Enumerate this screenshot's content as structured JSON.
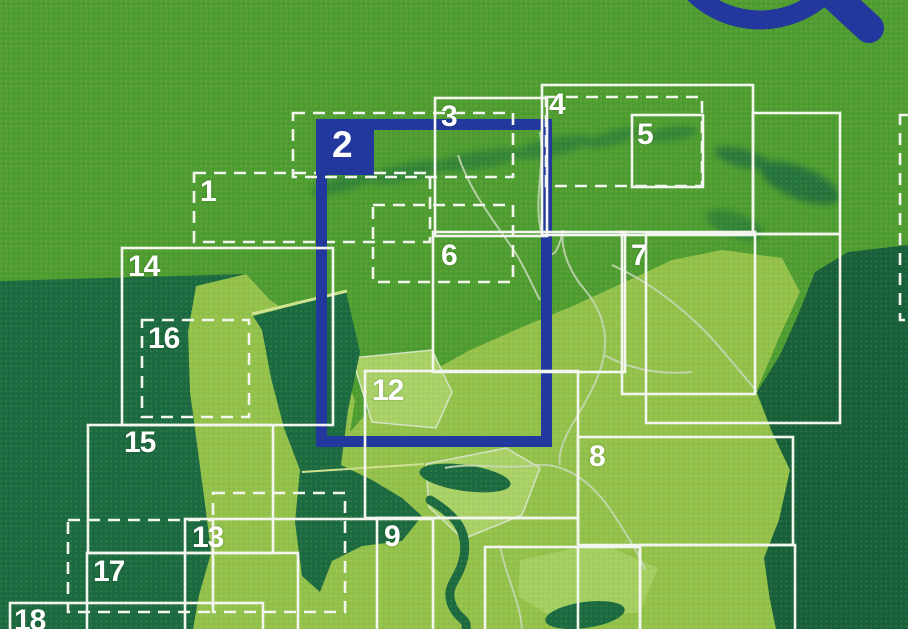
{
  "cover": {
    "description_label": "map-sheet-index-cover",
    "highlighted_sheet": "2"
  },
  "colors": {
    "background_green": "#4f9d32",
    "sea_dark_green": "#1c6a41",
    "germany_dark_green": "#185f3b",
    "land_light_green": "#93c14c",
    "land_lighter_green": "#a9d168",
    "box_line_white": "#f3f6ee",
    "province_border_gray": "#c9d8ba",
    "dike_light": "#cfe291",
    "highlight_blue": "#23389d"
  },
  "sheets": [
    {
      "num": "1",
      "style": "dashed",
      "box": [
        194,
        173,
        236,
        69
      ],
      "label_pos": [
        200,
        177
      ]
    },
    {
      "num": "2",
      "style": "highlight",
      "box": [
        316,
        119,
        236,
        328
      ],
      "tab": [
        319,
        119,
        55,
        56
      ],
      "label_pos": [
        332,
        126
      ]
    },
    {
      "num": "3",
      "style": "solid",
      "box": [
        435,
        98,
        112,
        138
      ],
      "label_pos": [
        441,
        102
      ]
    },
    {
      "num": "4",
      "style": "solid",
      "box": [
        542,
        85,
        211,
        150
      ],
      "label_pos": [
        549,
        90
      ]
    },
    {
      "num": "5",
      "style": "solid",
      "box": [
        632,
        115,
        71,
        72
      ],
      "label_pos": [
        637,
        120
      ]
    },
    {
      "num": "6",
      "style": "solid",
      "box": [
        433,
        232,
        192,
        140
      ],
      "label_pos": [
        441,
        241
      ]
    },
    {
      "num": "7",
      "style": "solid",
      "box": [
        622,
        232,
        133,
        162
      ],
      "label_pos": [
        631,
        241
      ]
    },
    {
      "num": "8",
      "style": "solid",
      "box": [
        578,
        437,
        215,
        108
      ],
      "label_pos": [
        589,
        442
      ]
    },
    {
      "num": "9",
      "style": "solid",
      "box": [
        377,
        518,
        201,
        120
      ],
      "label_pos": [
        384,
        522
      ]
    },
    {
      "num": "12",
      "style": "solid",
      "box": [
        365,
        371,
        213,
        147
      ],
      "label_pos": [
        372,
        376
      ]
    },
    {
      "num": "13",
      "style": "solid",
      "box": [
        185,
        519,
        248,
        120
      ],
      "label_pos": [
        192,
        523
      ]
    },
    {
      "num": "14",
      "style": "solid",
      "box": [
        122,
        248,
        211,
        177
      ],
      "label_pos": [
        128,
        252
      ]
    },
    {
      "num": "15",
      "style": "solid",
      "box": [
        88,
        425,
        185,
        128
      ],
      "label_pos": [
        124,
        428
      ]
    },
    {
      "num": "16",
      "style": "dashed",
      "box": [
        142,
        320,
        107,
        97
      ],
      "label_pos": [
        148,
        324
      ]
    },
    {
      "num": "17",
      "style": "solid",
      "box": [
        87,
        553,
        211,
        85
      ],
      "label_pos": [
        93,
        557
      ]
    },
    {
      "num": "18",
      "style": "solid",
      "box": [
        10,
        603,
        253,
        35
      ],
      "label_pos": [
        14,
        606
      ]
    }
  ],
  "extra_boxes": [
    {
      "style": "dashed",
      "box": [
        293,
        113,
        220,
        64
      ]
    },
    {
      "style": "dashed",
      "box": [
        373,
        205,
        140,
        77
      ]
    },
    {
      "style": "dashed",
      "box": [
        546,
        97,
        156,
        89
      ]
    },
    {
      "style": "dashed",
      "box": [
        68,
        520,
        145,
        92
      ]
    },
    {
      "style": "dashed",
      "box": [
        213,
        493,
        132,
        119
      ]
    },
    {
      "style": "dashed",
      "box": [
        900,
        115,
        100,
        205
      ]
    },
    {
      "style": "solid",
      "box": [
        646,
        234,
        194,
        189
      ]
    },
    {
      "style": "solid",
      "box": [
        753,
        113,
        87,
        121
      ]
    },
    {
      "style": "solid",
      "box": [
        485,
        547,
        155,
        90
      ]
    },
    {
      "style": "solid",
      "box": [
        640,
        545,
        155,
        90
      ]
    }
  ],
  "icons": {
    "magnifier": "magnifying-glass"
  }
}
